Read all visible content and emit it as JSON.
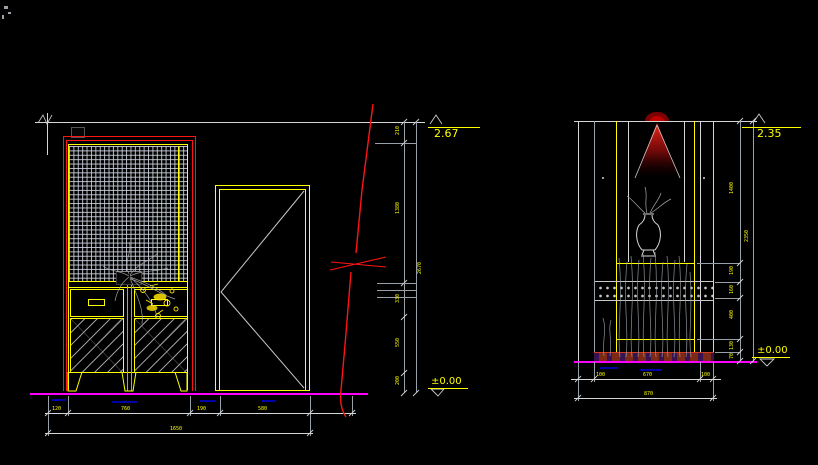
{
  "colors": {
    "background": "#000000",
    "line_white": "#d6d6d6",
    "dim_yellow": "#ffff00",
    "accent_red": "#ff1414",
    "floor_magenta": "#ff00ff",
    "hidden_blue": "#0000a8",
    "base_brown": "#7c2a15"
  },
  "left_view": {
    "elev_top": "2.67",
    "elev_floor": "±0.00",
    "chain_v": [
      "210",
      "1380",
      "330",
      "550",
      "200"
    ],
    "chain_v_total": "2670",
    "chain_h": [
      "120",
      "760",
      "190",
      "580"
    ],
    "chain_h_total": "1650"
  },
  "right_view": {
    "elev_top": "2.35",
    "elev_floor": "±0.00",
    "chain_v": [
      "1400",
      "190",
      "160",
      "400",
      "130",
      "70"
    ],
    "chain_v_total": "2350",
    "chain_h": [
      "100",
      "670",
      "100"
    ],
    "chain_h_total": "870"
  }
}
